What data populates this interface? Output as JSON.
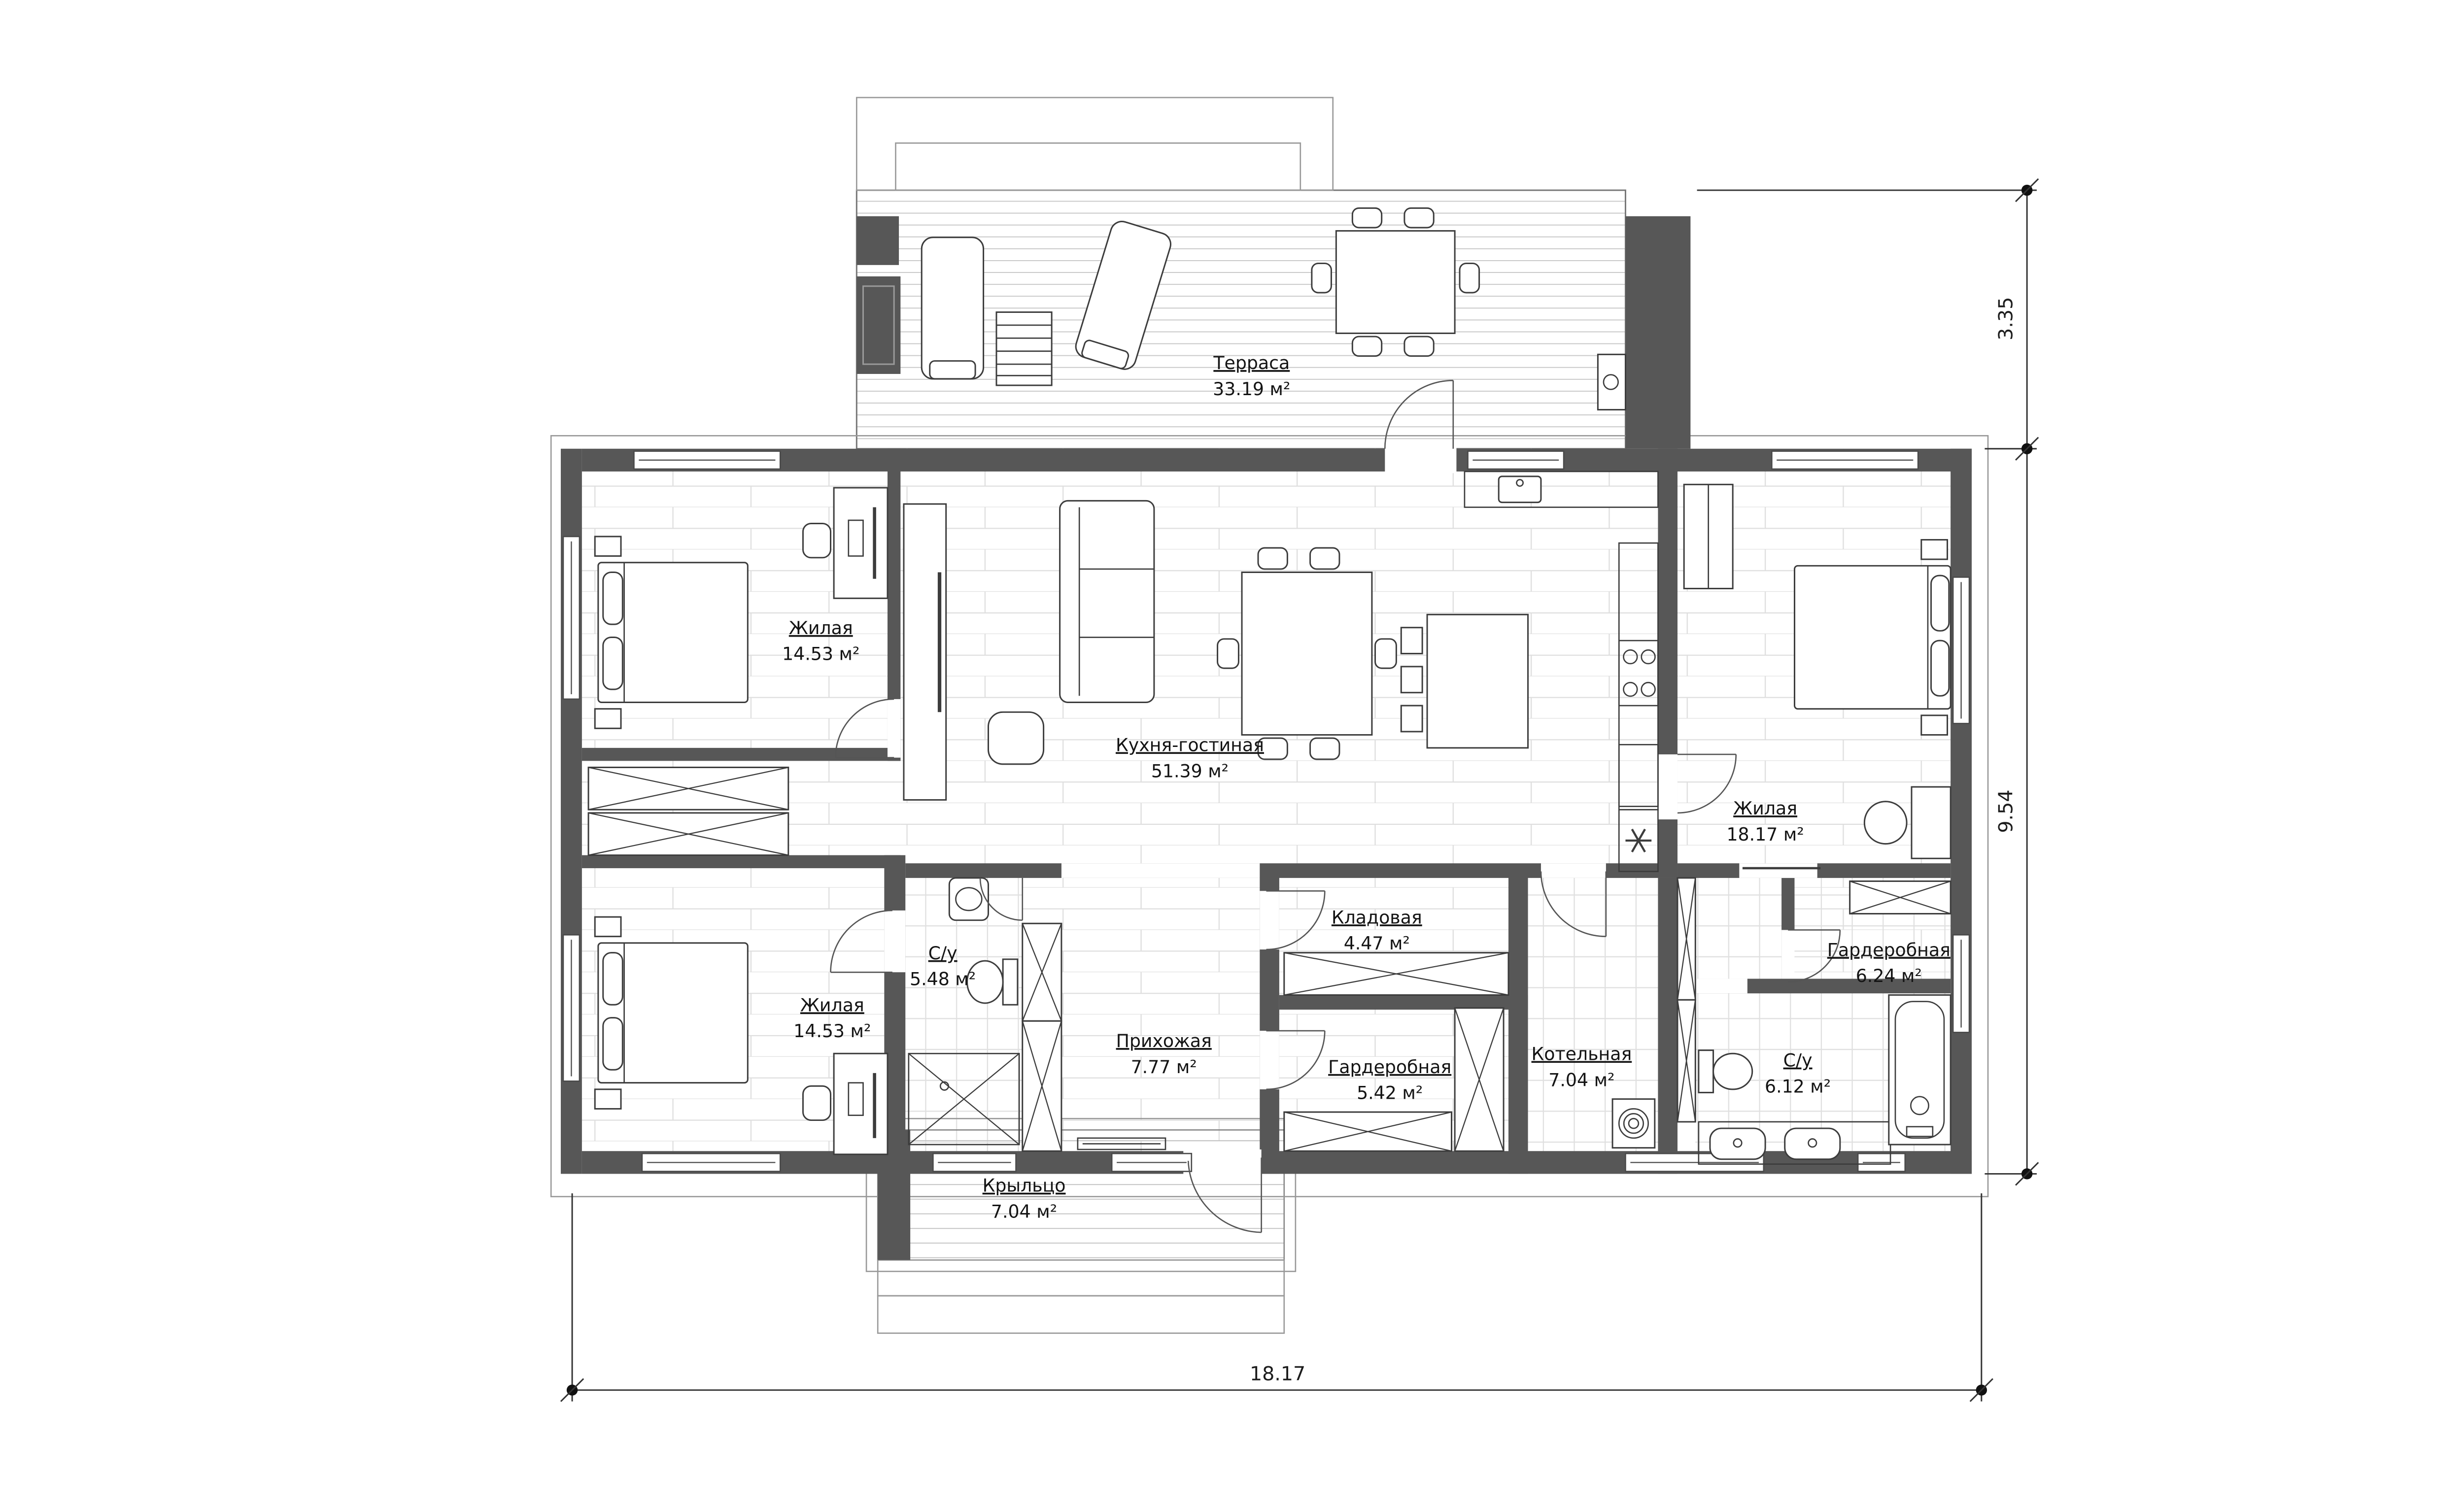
{
  "plan": {
    "rooms": [
      {
        "id": "terrace",
        "name": "Терраса",
        "area": "33.19 м²"
      },
      {
        "id": "bedroom-top-left",
        "name": "Жилая",
        "area": "14.53 м²"
      },
      {
        "id": "kitchen-living",
        "name": "Кухня-гостиная",
        "area": "51.39 м²"
      },
      {
        "id": "bedroom-right",
        "name": "Жилая",
        "area": "18.17 м²"
      },
      {
        "id": "bedroom-bottom-left",
        "name": "Жилая",
        "area": "14.53 м²"
      },
      {
        "id": "bathroom-small",
        "name": "С/у",
        "area": "5.48 м²"
      },
      {
        "id": "hallway",
        "name": "Прихожая",
        "area": "7.77 м²"
      },
      {
        "id": "storage",
        "name": "Кладовая",
        "area": "4.47 м²"
      },
      {
        "id": "wardrobe-1",
        "name": "Гардеробная",
        "area": "5.42 м²"
      },
      {
        "id": "boiler-room",
        "name": "Котельная",
        "area": "7.04 м²"
      },
      {
        "id": "bathroom-big",
        "name": "С/у",
        "area": "6.12 м²"
      },
      {
        "id": "wardrobe-2",
        "name": "Гардеробная",
        "area": "6.24 м²"
      },
      {
        "id": "porch",
        "name": "Крыльцо",
        "area": "7.04 м²"
      }
    ],
    "dimensions": {
      "right_top": "3.35",
      "right_main": "9.54",
      "bottom": "18.17"
    },
    "colors": {
      "wall": "#575757",
      "line": "#3c3c3c",
      "floor_hatch": "#d9d9d9",
      "background": "#ffffff"
    }
  }
}
